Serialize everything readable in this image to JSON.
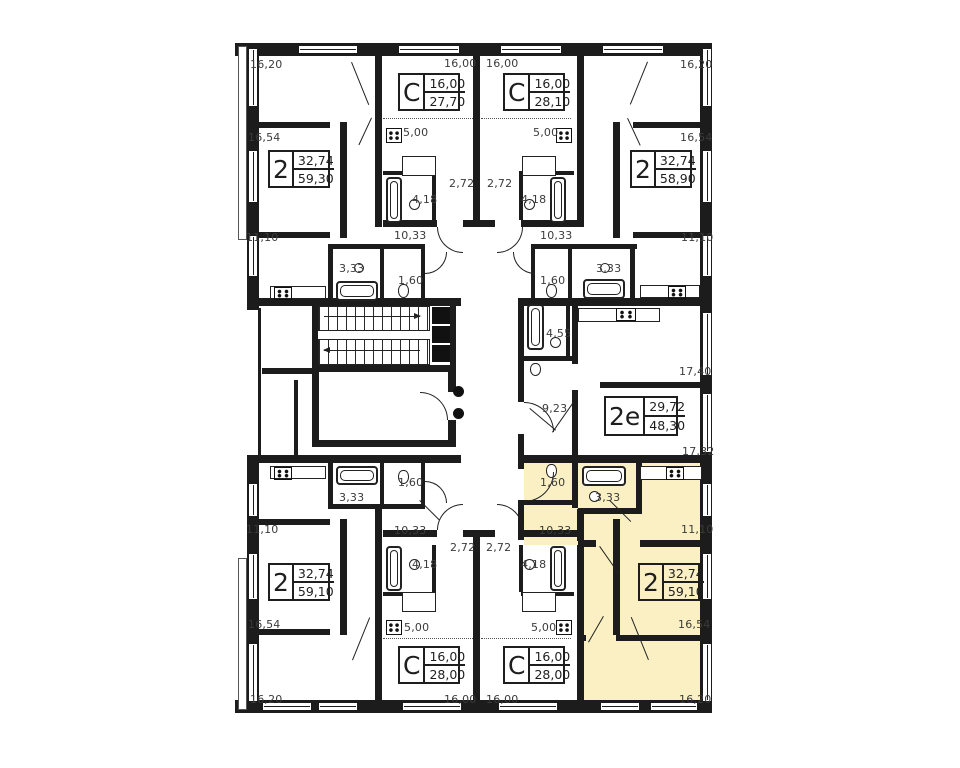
{
  "plan": {
    "highlight_color": "#FAF0C3",
    "wall_color": "#1C1C1C",
    "apartments": [
      {
        "id": "top-left-2",
        "type": "2",
        "area_living": "32,74",
        "area_total": "59,30",
        "highlighted": false
      },
      {
        "id": "top-studio-left",
        "type": "С",
        "area_living": "16,00",
        "area_total": "27,70",
        "highlighted": false
      },
      {
        "id": "top-studio-right",
        "type": "С",
        "area_living": "16,00",
        "area_total": "28,10",
        "highlighted": false
      },
      {
        "id": "top-right-2",
        "type": "2",
        "area_living": "32,74",
        "area_total": "58,90",
        "highlighted": false
      },
      {
        "id": "right-2e",
        "type": "2е",
        "area_living": "29,72",
        "area_total": "48,30",
        "highlighted": false
      },
      {
        "id": "bottom-left-2",
        "type": "2",
        "area_living": "32,74",
        "area_total": "59,10",
        "highlighted": false
      },
      {
        "id": "bottom-studio-left",
        "type": "С",
        "area_living": "16,00",
        "area_total": "28,00",
        "highlighted": false
      },
      {
        "id": "bottom-studio-right",
        "type": "С",
        "area_living": "16,00",
        "area_total": "28,00",
        "highlighted": false
      },
      {
        "id": "bottom-right-2",
        "type": "2",
        "area_living": "32,74",
        "area_total": "59,10",
        "highlighted": true
      }
    ],
    "dim_labels": [
      {
        "text": "16,20",
        "x": 250,
        "y": 58
      },
      {
        "text": "16,00",
        "x": 444,
        "y": 57
      },
      {
        "text": "16,00",
        "x": 486,
        "y": 57
      },
      {
        "text": "16,20",
        "x": 680,
        "y": 58
      },
      {
        "text": "16,54",
        "x": 248,
        "y": 131
      },
      {
        "text": "16,54",
        "x": 680,
        "y": 131
      },
      {
        "text": "5,00",
        "x": 403,
        "y": 126
      },
      {
        "text": "5,00",
        "x": 533,
        "y": 126
      },
      {
        "text": "2,72",
        "x": 449,
        "y": 177
      },
      {
        "text": "2,72",
        "x": 487,
        "y": 177
      },
      {
        "text": "4,18",
        "x": 412,
        "y": 193
      },
      {
        "text": "4,18",
        "x": 521,
        "y": 193
      },
      {
        "text": "11,10",
        "x": 246,
        "y": 231
      },
      {
        "text": "10,33",
        "x": 394,
        "y": 229
      },
      {
        "text": "10,33",
        "x": 540,
        "y": 229
      },
      {
        "text": "11,10",
        "x": 681,
        "y": 231
      },
      {
        "text": "3,33",
        "x": 339,
        "y": 262
      },
      {
        "text": "3,33",
        "x": 596,
        "y": 262
      },
      {
        "text": "1,60",
        "x": 398,
        "y": 274
      },
      {
        "text": "1,60",
        "x": 540,
        "y": 274
      },
      {
        "text": "4,55",
        "x": 546,
        "y": 327
      },
      {
        "text": "17,40",
        "x": 679,
        "y": 365
      },
      {
        "text": "9,23",
        "x": 542,
        "y": 402
      },
      {
        "text": "17,32",
        "x": 682,
        "y": 445
      },
      {
        "text": "1,60",
        "x": 398,
        "y": 476
      },
      {
        "text": "1,60",
        "x": 540,
        "y": 476
      },
      {
        "text": "3,33",
        "x": 339,
        "y": 491
      },
      {
        "text": "3,33",
        "x": 595,
        "y": 491
      },
      {
        "text": "11,10",
        "x": 246,
        "y": 523
      },
      {
        "text": "10,33",
        "x": 394,
        "y": 524
      },
      {
        "text": "10,33",
        "x": 539,
        "y": 524
      },
      {
        "text": "11,10",
        "x": 681,
        "y": 523
      },
      {
        "text": "2,72",
        "x": 450,
        "y": 541
      },
      {
        "text": "2,72",
        "x": 486,
        "y": 541
      },
      {
        "text": "4,18",
        "x": 412,
        "y": 558
      },
      {
        "text": "4,18",
        "x": 521,
        "y": 558
      },
      {
        "text": "16,54",
        "x": 248,
        "y": 618
      },
      {
        "text": "16,54",
        "x": 678,
        "y": 618
      },
      {
        "text": "5,00",
        "x": 404,
        "y": 621
      },
      {
        "text": "5,00",
        "x": 531,
        "y": 621
      },
      {
        "text": "16,20",
        "x": 250,
        "y": 693
      },
      {
        "text": "16,00",
        "x": 444,
        "y": 693
      },
      {
        "text": "16,00",
        "x": 486,
        "y": 693
      },
      {
        "text": "16,20",
        "x": 679,
        "y": 693
      }
    ]
  }
}
